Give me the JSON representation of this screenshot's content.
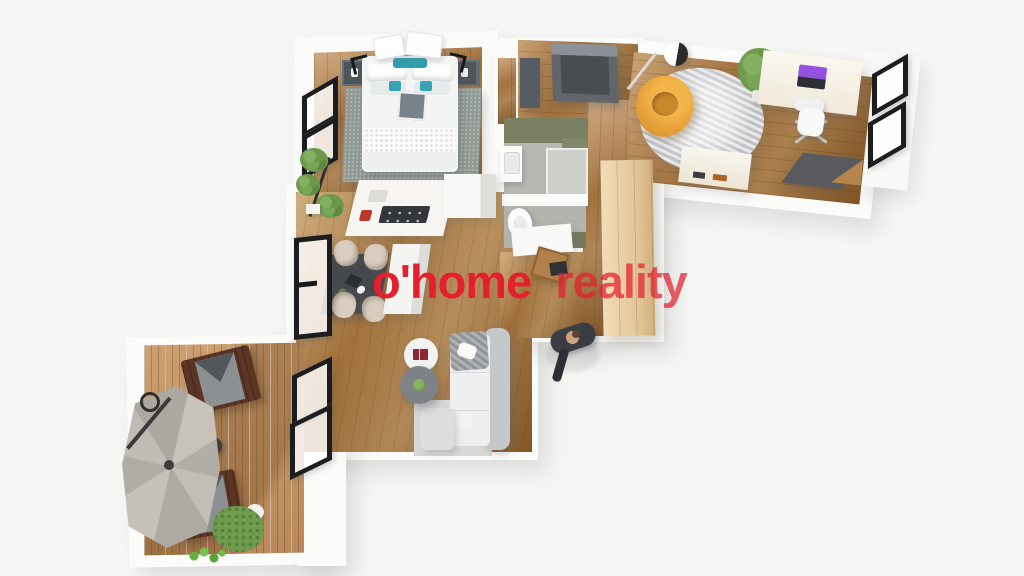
{
  "watermark": {
    "brand": "o'home",
    "suffix": "reality",
    "color_primary": "#e4202e"
  },
  "scene": {
    "description": "3D top-down rendered floor plan of an apartment with terrace",
    "background_color": "#f6f6f4",
    "palette": {
      "wood_floor": "#9a6a37",
      "terrace_deck": "#c59a6b",
      "walls": "#fbfbf9",
      "bedroom_rug": "#8f9893",
      "accent_pillow_teal": "#2f9fae",
      "armchair_yellow": "#e6a138",
      "bathroom_green": "#7b7f62",
      "wardrobe_wood": "#e2c496",
      "umbrella_gray": "#b8b4ac",
      "lounger_brown": "#5d3525",
      "window_frame_black": "#1b1d1f",
      "laptop_screen_purple": "#9550e0"
    },
    "rooms": [
      {
        "name": "bedroom",
        "furniture": [
          "double-bed",
          "teal-pillows",
          "two-nightstands",
          "gray-area-rug",
          "wall-art",
          "two-windows"
        ]
      },
      {
        "name": "entry-hall",
        "furniture": [
          "dark-storage-bench",
          "dark-cabinet"
        ]
      },
      {
        "name": "office",
        "furniture": [
          "white-desk",
          "laptop",
          "office-chair",
          "yellow-lounge-chair",
          "arc-floor-lamp",
          "round-gray-rug",
          "potted-plant",
          "sideboard",
          "doormat",
          "two-windows"
        ]
      },
      {
        "name": "bathroom",
        "furniture": [
          "vanity-with-basin",
          "shower-tray",
          "olive-green-walls"
        ]
      },
      {
        "name": "wc",
        "furniture": [
          "toilet",
          "olive-green-wall"
        ]
      },
      {
        "name": "hallway",
        "furniture": [
          "light-wood-wardrobe"
        ]
      },
      {
        "name": "living-dining-kitchen",
        "furniture": [
          "kitchen-island-with-cooktop",
          "kitchen-column",
          "dining-table",
          "four-beige-chairs",
          "second-island",
          "l-shaped-sofa",
          "ottoman",
          "white-coffee-table-with-book",
          "gray-coffee-table-with-plant",
          "light-rug",
          "plant-stand",
          "work-desk-with-chair",
          "tall-window",
          "terrace-doors"
        ]
      },
      {
        "name": "terrace",
        "furniture": [
          "wood-decking",
          "cantilever-parasol",
          "two-wooden-loungers",
          "small-side-table",
          "green-planter",
          "edge-plants"
        ]
      }
    ],
    "figure": "person standing at the apartment entrance"
  }
}
